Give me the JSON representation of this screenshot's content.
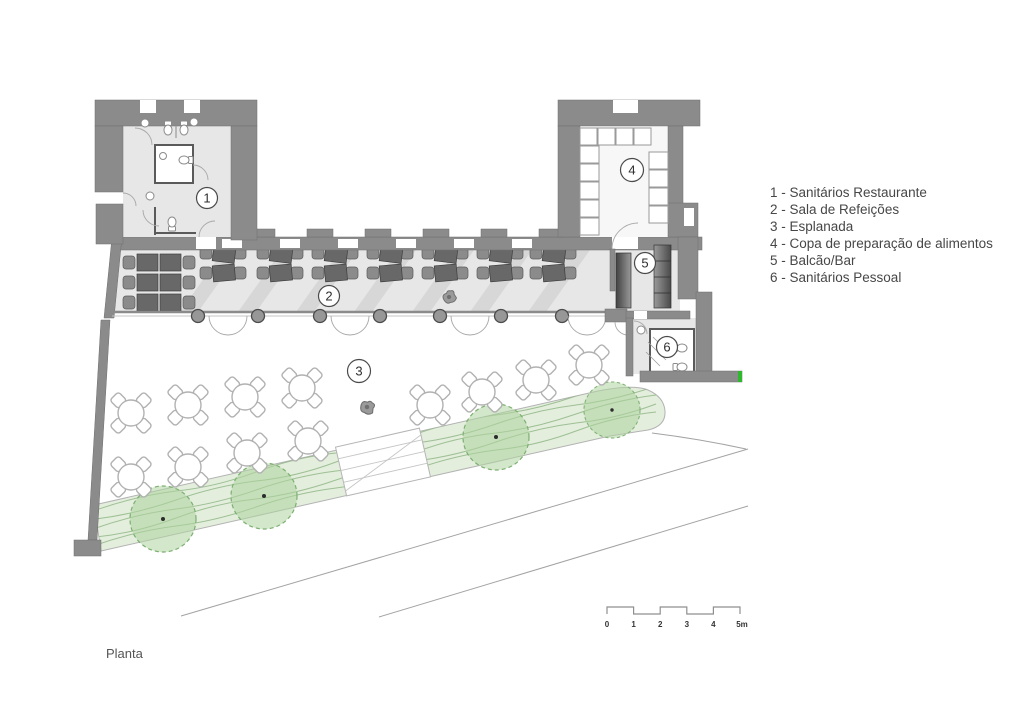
{
  "title": "Planta",
  "legend": {
    "items": [
      "1 - Sanitários Restaurante",
      "2 - Sala de Refeições",
      "3 - Esplanada",
      "4 - Copa de preparação de alimentos",
      "5 - Balcão/Bar",
      "6 - Sanitários Pessoal"
    ]
  },
  "plan": {
    "room_labels": {
      "r1": "1",
      "r2": "2",
      "r3": "3",
      "r4": "4",
      "r5": "5",
      "r6": "6"
    }
  },
  "scale_bar": {
    "ticks": [
      "0",
      "1",
      "2",
      "3",
      "4",
      "5m"
    ]
  },
  "colors": {
    "wall": "#8b8b8b",
    "floor": "#e7e7e7",
    "planting": "#dcead4",
    "tree": "#aed49e",
    "green_accent": "#2eb82e",
    "text": "#474747"
  }
}
